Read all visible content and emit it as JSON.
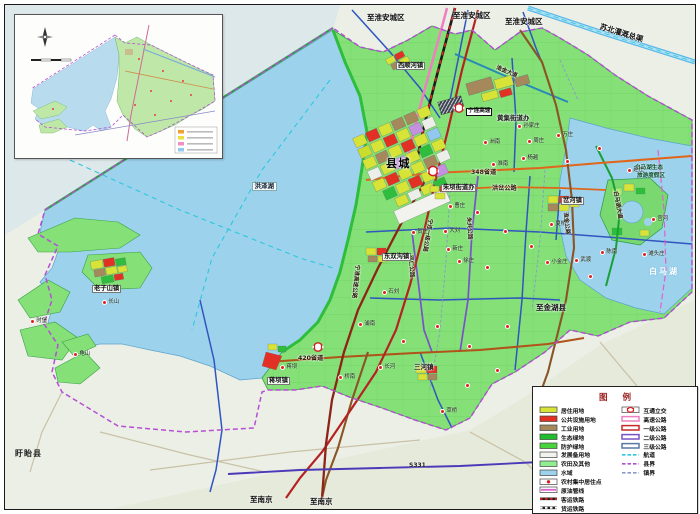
{
  "figure": {
    "width": 700,
    "height": 514,
    "kind": "county-land-use-planning-map"
  },
  "colors": {
    "land_green": "#84e077",
    "lake_blue": "#9dd2ec",
    "outside": "#ecefe6",
    "residential": "#d7e437",
    "public_facility": "#e23124",
    "industrial": "#a6885d",
    "eco_green": "#22bd2c",
    "protect_green": "#4ad43c",
    "reserve": "#f2f2ee",
    "farmland": "#90ee90",
    "water": "#9dd2ec",
    "expressway": "#ee7fc0",
    "road1": "#c62828",
    "road2": "#7a52c8",
    "road3": "#5878a8",
    "waterway": "#2cc8dc",
    "county_line": "#b44fd4",
    "town_line": "#8a9ac8",
    "pipeline": "#e060d0",
    "canal": "#58b8e8",
    "s_road": "#e0661c",
    "brown_road": "#8a5526"
  },
  "legend": {
    "title": "图  例",
    "left": [
      {
        "label": "居住用地",
        "type": "fill",
        "color": "#d7e437"
      },
      {
        "label": "公共设施用地",
        "type": "fill",
        "color": "#e23124"
      },
      {
        "label": "工业用地",
        "type": "fill",
        "color": "#a6885d"
      },
      {
        "label": "生态绿地",
        "type": "fill",
        "color": "#22bd2c"
      },
      {
        "label": "防护绿地",
        "type": "fill",
        "color": "#4ad43c"
      },
      {
        "label": "发展备用地",
        "type": "fill",
        "color": "#f2f2ee"
      },
      {
        "label": "农田及其他",
        "type": "fill",
        "color": "#90ee90"
      },
      {
        "label": "水域",
        "type": "fill",
        "color": "#9dd2ec"
      },
      {
        "label": "农村集中居住点",
        "type": "village",
        "color": "#e02020"
      },
      {
        "label": "原油管线",
        "type": "pipeline",
        "color": "#e060d0"
      },
      {
        "label": "客运铁路",
        "type": "railp",
        "color": "#e02020"
      },
      {
        "label": "货运铁路",
        "type": "railf",
        "color": "#222222"
      }
    ],
    "right": [
      {
        "label": "互通立交",
        "type": "inter",
        "color": "#e02020"
      },
      {
        "label": "高速公路",
        "type": "dline",
        "color": "#ee7fc0"
      },
      {
        "label": "一级公路",
        "type": "dline",
        "color": "#c62828"
      },
      {
        "label": "二级公路",
        "type": "dline",
        "color": "#7a52c8"
      },
      {
        "label": "三级公路",
        "type": "dline",
        "color": "#5878a8"
      },
      {
        "label": "航道",
        "type": "dash",
        "color": "#2cc8dc"
      },
      {
        "label": "县界",
        "type": "dash",
        "color": "#b44fd4"
      },
      {
        "label": "镇界",
        "type": "dash",
        "color": "#8a9ac8"
      }
    ]
  },
  "map_labels": [
    {
      "text": "至淮安城区",
      "x": 362,
      "y": 9,
      "cls": "dir"
    },
    {
      "text": "至淮安城区",
      "x": 448,
      "y": 7,
      "cls": "dir"
    },
    {
      "text": "至淮安城区",
      "x": 500,
      "y": 13,
      "cls": "dir"
    },
    {
      "text": "苏北灌溉总渠",
      "x": 596,
      "y": 18,
      "cls": "dir",
      "rot": 17
    },
    {
      "text": "西顺河镇",
      "x": 391,
      "y": 57,
      "cls": "townbox"
    },
    {
      "text": "淮金大道",
      "x": 492,
      "y": 61,
      "cls": "roadrot",
      "rot": 22
    },
    {
      "text": "宁连高速",
      "x": 461,
      "y": 103,
      "cls": "roadbox"
    },
    {
      "text": "黄集街道办",
      "x": 492,
      "y": 110,
      "cls": "town"
    },
    {
      "text": "县城",
      "x": 381,
      "y": 153,
      "cls": "city"
    },
    {
      "text": "348省道",
      "x": 466,
      "y": 165,
      "cls": "road"
    },
    {
      "text": "洪泽湖",
      "x": 247,
      "y": 177,
      "cls": "waterbox"
    },
    {
      "text": "朱坝街道办",
      "x": 436,
      "y": 179,
      "cls": "townbox"
    },
    {
      "text": "洪岔公路",
      "x": 487,
      "y": 181,
      "cls": "road"
    },
    {
      "text": "岔河镇",
      "x": 556,
      "y": 192,
      "cls": "townbox"
    },
    {
      "text": "白马湖生态",
      "x": 630,
      "y": 161,
      "cls": "resort"
    },
    {
      "text": "旅游度假区",
      "x": 632,
      "y": 169,
      "cls": "resort"
    },
    {
      "text": "白马湖大道",
      "x": 612,
      "y": 186,
      "cls": "roadrot",
      "rot": 80
    },
    {
      "text": "淮金公路",
      "x": 562,
      "y": 207,
      "cls": "roadrot",
      "rot": 84
    },
    {
      "text": "宁连一级公路",
      "x": 427,
      "y": 214,
      "cls": "roadrot",
      "rot": 100
    },
    {
      "text": "朱共公路",
      "x": 465,
      "y": 212,
      "cls": "roadrot",
      "rot": 86
    },
    {
      "text": "双仁公路",
      "x": 407,
      "y": 250,
      "cls": "roadrot",
      "rot": 86
    },
    {
      "text": "宁淮高速公路",
      "x": 354,
      "y": 260,
      "cls": "roadrot",
      "rot": 96
    },
    {
      "text": "东双沟镇",
      "x": 377,
      "y": 248,
      "cls": "townbox"
    },
    {
      "text": "老子山镇",
      "x": 87,
      "y": 280,
      "cls": "townbox"
    },
    {
      "text": "至金湖县",
      "x": 531,
      "y": 299,
      "cls": "dir"
    },
    {
      "text": "白马湖",
      "x": 644,
      "y": 263,
      "cls": "water"
    },
    {
      "text": "420省道",
      "x": 293,
      "y": 351,
      "cls": "road"
    },
    {
      "text": "三河镇",
      "x": 409,
      "y": 359,
      "cls": "town"
    },
    {
      "text": "蒋坝镇",
      "x": 262,
      "y": 372,
      "cls": "townbox"
    },
    {
      "text": "S331",
      "x": 404,
      "y": 458,
      "cls": "roadsm"
    },
    {
      "text": "至南京",
      "x": 245,
      "y": 491,
      "cls": "dir"
    },
    {
      "text": "至南京",
      "x": 305,
      "y": 493,
      "cls": "dir"
    },
    {
      "text": "盱眙县",
      "x": 10,
      "y": 445,
      "cls": "county"
    }
  ],
  "villages": [
    {
      "name": "孙家庄",
      "x": 512,
      "y": 121
    },
    {
      "name": "洲南",
      "x": 478,
      "y": 137
    },
    {
      "name": "周庄",
      "x": 522,
      "y": 136
    },
    {
      "name": "万庄",
      "x": 551,
      "y": 130
    },
    {
      "name": "杨越",
      "x": 516,
      "y": 153
    },
    {
      "name": "淮南",
      "x": 486,
      "y": 159
    },
    {
      "name": "曹庄",
      "x": 443,
      "y": 201
    },
    {
      "name": "贺庄",
      "x": 406,
      "y": 227
    },
    {
      "name": "大刘",
      "x": 438,
      "y": 226
    },
    {
      "name": "新庄",
      "x": 441,
      "y": 244
    },
    {
      "name": "徐庄",
      "x": 452,
      "y": 256
    },
    {
      "name": "夏桥",
      "x": 544,
      "y": 219
    },
    {
      "name": "小金庄",
      "x": 540,
      "y": 257
    },
    {
      "name": "武渡",
      "x": 569,
      "y": 255
    },
    {
      "name": "陈南",
      "x": 595,
      "y": 247
    },
    {
      "name": "赵庄",
      "x": 622,
      "y": 165
    },
    {
      "name": "宫河",
      "x": 646,
      "y": 214
    },
    {
      "name": "滩头庄",
      "x": 637,
      "y": 249
    },
    {
      "name": "石刘",
      "x": 377,
      "y": 287
    },
    {
      "name": "浦南",
      "x": 353,
      "y": 319
    },
    {
      "name": "长山",
      "x": 97,
      "y": 297
    },
    {
      "name": "龟山",
      "x": 68,
      "y": 349
    },
    {
      "name": "时堡",
      "x": 25,
      "y": 316
    },
    {
      "name": "蒋坝",
      "x": 275,
      "y": 362
    },
    {
      "name": "桥南",
      "x": 333,
      "y": 372
    },
    {
      "name": "长河",
      "x": 373,
      "y": 362
    },
    {
      "name": "草桥",
      "x": 435,
      "y": 406
    },
    {
      "name": "",
      "x": 470,
      "y": 207
    },
    {
      "name": "",
      "x": 498,
      "y": 226
    },
    {
      "name": "",
      "x": 524,
      "y": 241
    },
    {
      "name": "",
      "x": 583,
      "y": 271
    },
    {
      "name": "",
      "x": 560,
      "y": 156
    },
    {
      "name": "",
      "x": 480,
      "y": 262
    },
    {
      "name": "",
      "x": 430,
      "y": 321
    },
    {
      "name": "",
      "x": 462,
      "y": 341
    },
    {
      "name": "",
      "x": 500,
      "y": 321
    },
    {
      "name": "",
      "x": 396,
      "y": 336
    },
    {
      "name": "",
      "x": 592,
      "y": 143
    },
    {
      "name": "",
      "x": 460,
      "y": 380
    },
    {
      "name": "",
      "x": 490,
      "y": 365
    }
  ]
}
